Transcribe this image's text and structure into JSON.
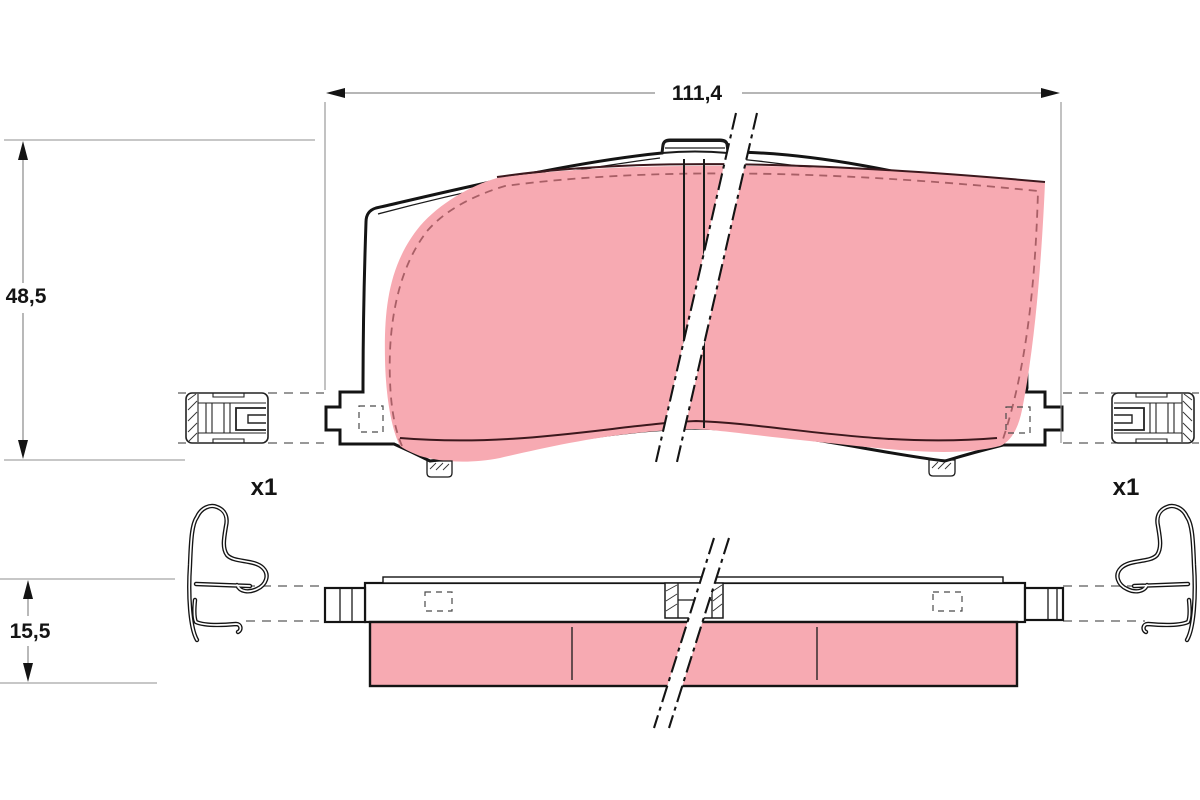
{
  "drawing": {
    "type": "brake-pad-technical-drawing",
    "views": {
      "front_view": "pad front elevation",
      "side_view": "pad thickness profile"
    }
  },
  "dimensions": {
    "width": {
      "label": "111,4"
    },
    "height": {
      "label": "48,5"
    },
    "thickness": {
      "label": "15,5"
    }
  },
  "accessories": {
    "left_quantity_label": "x1",
    "right_quantity_label": "x1"
  },
  "colors": {
    "background": "#ffffff",
    "outline": "#141414",
    "friction_material": "#f7aab2",
    "friction_boundary_dash": "#a85f66",
    "dimension_line": "#8a8a8a"
  }
}
